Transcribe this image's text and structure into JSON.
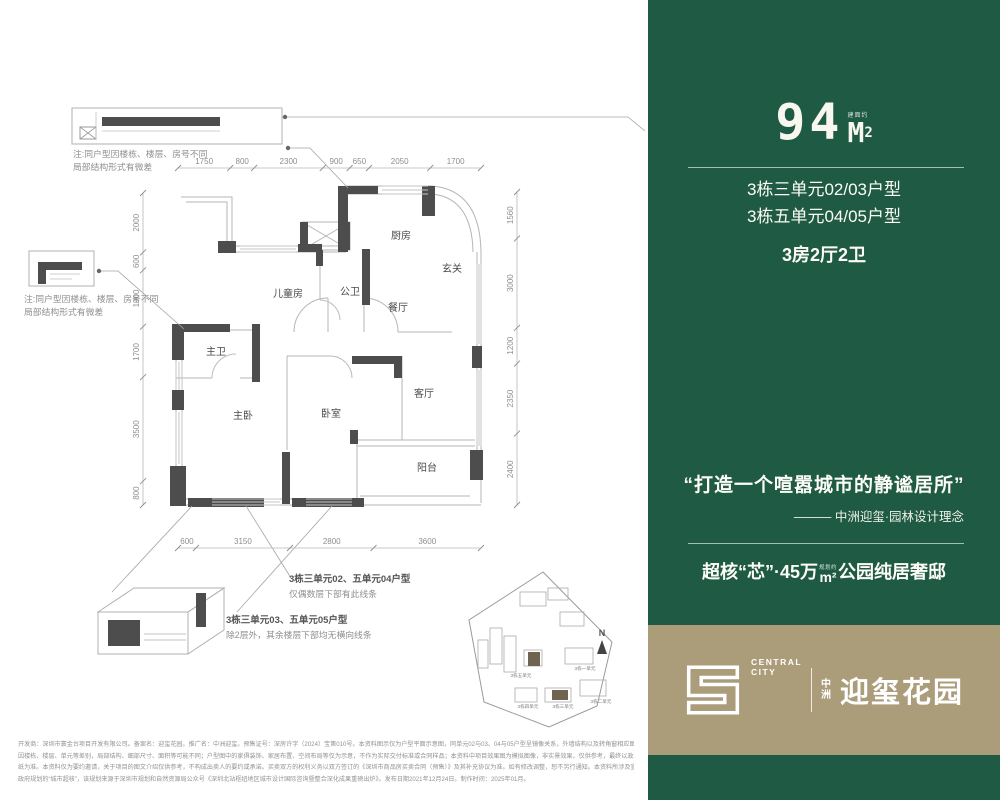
{
  "panel": {
    "area_number": "94",
    "area_unit": "M",
    "area_sup": "2",
    "area_tiny": "建面约",
    "unit_line1": "3栋三单元02/03户型",
    "unit_line2": "3栋五单元04/05户型",
    "layout": "3房2厅2卫",
    "quote": "“打造一个喧嚣城市的静谧居所”",
    "attribution": "——— 中洲迎玺·园林设计理念",
    "tagline_prefix": "超核“芯”·45万",
    "tagline_tiny": "规划约",
    "tagline_unit": "m²",
    "tagline_suffix": "公园纯居奢邸"
  },
  "logo": {
    "brand_top": "CENTRAL",
    "brand_bottom": "CITY",
    "cn_top": "中",
    "cn_bottom": "洲",
    "name": "迎玺花园"
  },
  "floorplan": {
    "rooms": [
      "厨房",
      "玄关",
      "餐厅",
      "公卫",
      "儿童房",
      "主卫",
      "主卧",
      "卧室",
      "客厅",
      "阳台"
    ],
    "dims_top": [
      "1750",
      "800",
      "2300",
      "900",
      "650",
      "2050",
      "1700"
    ],
    "dims_left": [
      "2000",
      "600",
      "1900",
      "1700",
      "3500",
      "800"
    ],
    "dims_right": [
      "1560",
      "3000",
      "1200",
      "2350",
      "2400"
    ],
    "dims_bottom": [
      "600",
      "3150",
      "2800",
      "3600"
    ],
    "note1": {
      "line1": "注:同户型因楼栋、楼层、房号不同",
      "line2": "局部结构形式有微差"
    },
    "note2": {
      "line1": "注:同户型因楼栋、楼层、房号不同",
      "line2": "局部结构形式有微差"
    },
    "callout1": {
      "title": "3栋三单元02、五单元04户型",
      "sub": "仅偶数层下部有此线条"
    },
    "callout2": {
      "title": "3栋三单元03、五单元05户型",
      "sub": "除2层外，其余楼层下部均无横向线条"
    }
  },
  "site_map": {
    "labels": [
      "3栋一单元",
      "3栋二单元",
      "3栋三单元",
      "3栋四单元",
      "3栋五单元"
    ],
    "compass": "N"
  },
  "colors": {
    "green": "#1e5a44",
    "tan": "#ab9c7a"
  },
  "disclaimer": {
    "lines": [
      "开发商：深圳市寰金台项目开发有限公司。备案名：迎玺花园。推广名：中洲迎玺。预售证号：深房许字（2024）宝第010号。本资料图示仅为户型平面示意图，同单元02与03、04与05户型呈镜像关系，外墙结构以及转角窗相应图示外，室内空间完全镜像，相同户型单位",
      "因楼栋、楼层、单元等差别，局部结构、细部尺寸、面积等可能不同；户型图中的家俱装饰、家居布置、空间布局等仅为示意，不作为实际交付标准或合同样品；本资料中项目效果图为模拟图像，非实景效果，仅供参考，最终以政府批准的建筑工程施工图及其对应工程图",
      "纸为准。本资料仅为要约邀请，关于项目的图文介绍仅供参考，不构成出卖人的要约或承诺。买卖双方的权利义务以双方签订的《深圳市商品房买卖合同（预售）》及其补充协议为准。如有修改调整，恕不另行通知。本资料所涉及宣传资料，信息来源：“超核”指代",
      "政府规划的“城市超核”，该规划来源于深圳市规划和自然资源局公众号《深圳北站枢纽地区城市设计国际咨询暨整合深化成果重磅出炉》。发布日期2021年12月24日。制作时间：2025年01月。"
    ]
  }
}
